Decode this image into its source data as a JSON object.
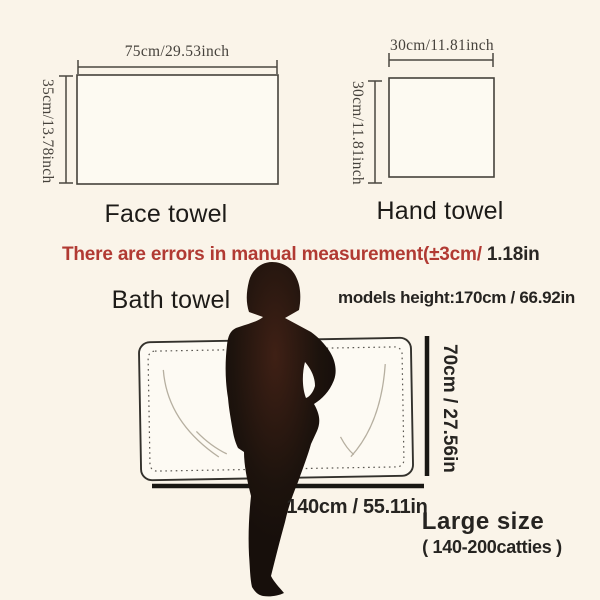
{
  "colors": {
    "background": "#faf4e9",
    "towel_fill": "#fdfaf2",
    "towel_outline": "#45423b",
    "bath_outline": "#33312c",
    "stitch_dotted": "#5a5751",
    "accent_red": "#b13a33",
    "text_dark": "#262421",
    "serif_text": "#46423c",
    "thick_line": "#191713",
    "silhouette": "#170f0b",
    "silhouette_center": "#3f2015",
    "fold_line": "#b6afa0"
  },
  "face_towel": {
    "label": "Face towel",
    "width_label": "75cm/29.53inch",
    "height_label": "35cm/13.78inch"
  },
  "hand_towel": {
    "label": "Hand towel",
    "width_label": "30cm/11.81inch",
    "height_label": "30cm/11.81inch"
  },
  "disclaimer": {
    "red_part": "There are errors in manual measurement(±3cm/",
    "black_part": " 1.18in"
  },
  "bath_towel": {
    "label": "Bath towel",
    "model_height": "models height:170cm / 66.92in",
    "width_label": "140cm / 55.11in",
    "height_label": "70cm / 27.56in",
    "size_title": "Large size",
    "size_range": "( 140-200catties )"
  }
}
